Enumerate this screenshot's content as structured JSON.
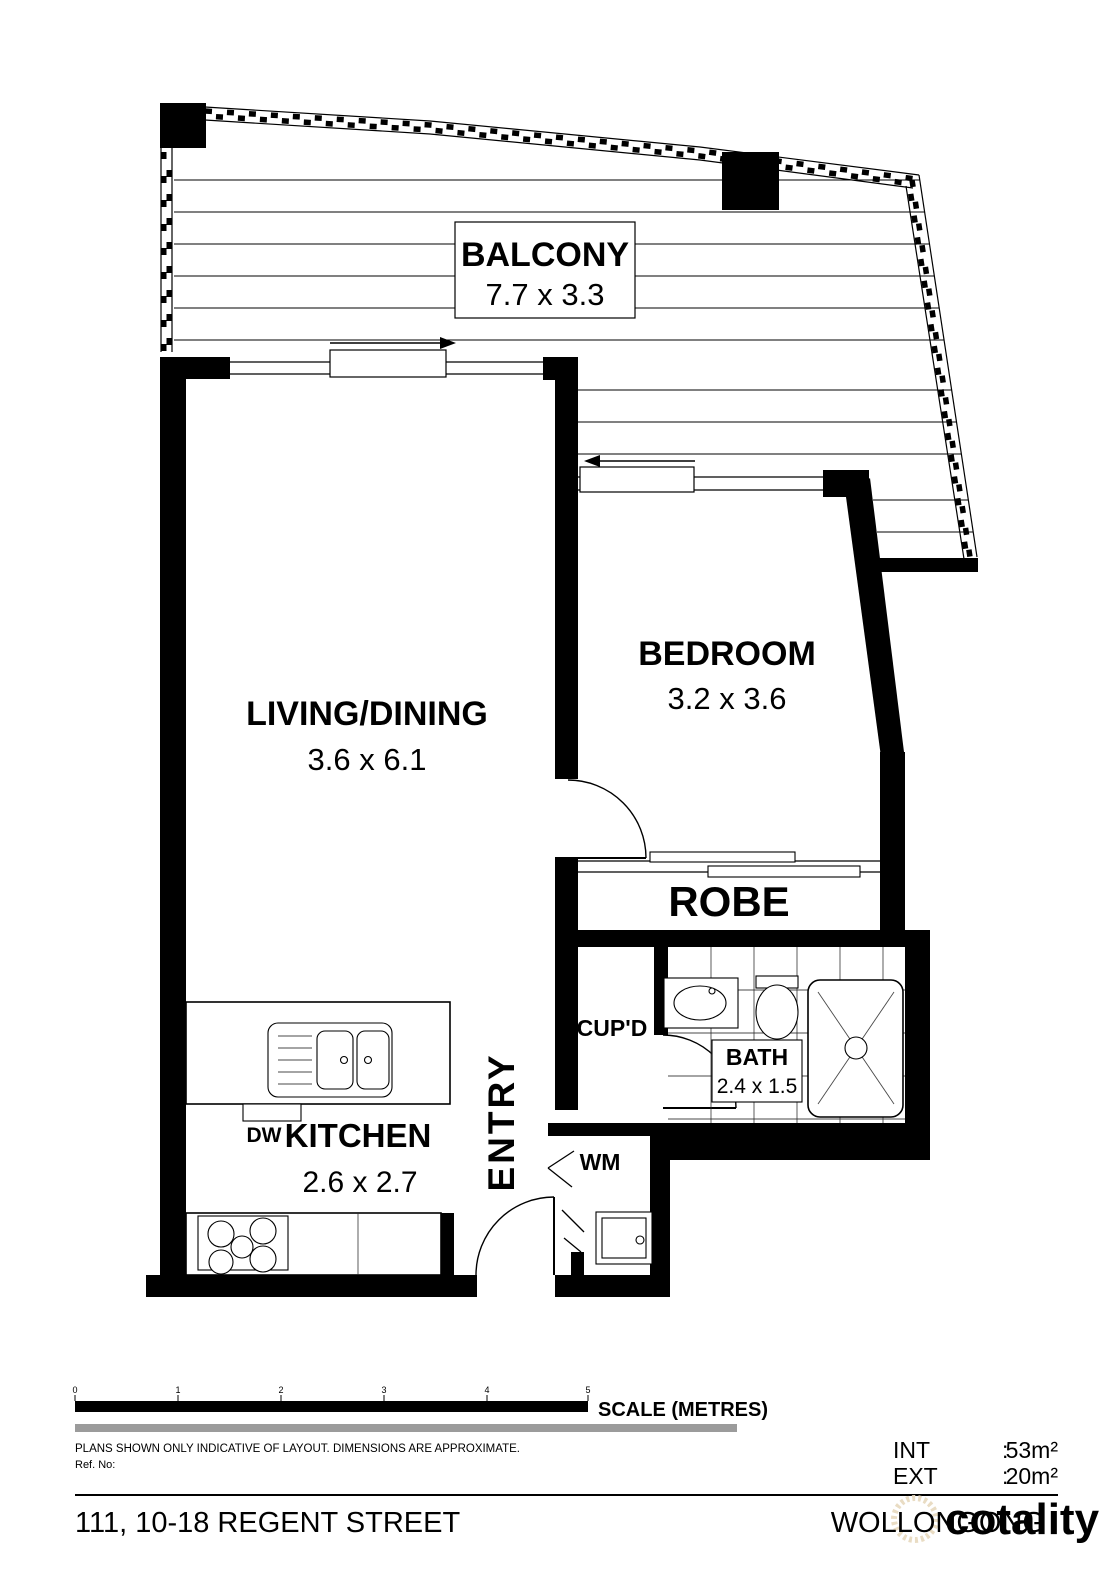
{
  "plan": {
    "balcony": {
      "name": "BALCONY",
      "dims": "7.7 x 3.3"
    },
    "living": {
      "name": "LIVING/DINING",
      "dims": "3.6 x 6.1"
    },
    "bedroom": {
      "name": "BEDROOM",
      "dims": "3.2 x 3.6"
    },
    "robe": {
      "name": "ROBE"
    },
    "cupboard": {
      "name": "CUP'D"
    },
    "bath": {
      "name": "BATH",
      "dims": "2.4 x 1.5"
    },
    "kitchen": {
      "name": "KITCHEN",
      "dims": "2.6 x 2.7"
    },
    "entry": {
      "name": "ENTRY"
    },
    "wm": {
      "name": "WM"
    },
    "dw": {
      "name": "DW"
    }
  },
  "footer": {
    "scale": {
      "label": "SCALE (METRES)",
      "ticks": [
        "0",
        "1",
        "2",
        "3",
        "4",
        "5"
      ]
    },
    "disclaimer": "PLANS SHOWN ONLY INDICATIVE OF LAYOUT.  DIMENSIONS ARE APPROXIMATE.",
    "ref_label": "Ref. No:",
    "areas": {
      "int_label": "INT",
      "int_sep": ":",
      "int_value": "53m²",
      "ext_label": "EXT",
      "ext_sep": ":",
      "ext_value": "20m²"
    },
    "address": "111, 10-18 REGENT STREET",
    "suburb": "WOLLONGONG",
    "watermark": "cotality"
  },
  "colors": {
    "wall": "#000000",
    "scale_gray": "#9b9b9b",
    "watermark": "#e9dcc3"
  }
}
